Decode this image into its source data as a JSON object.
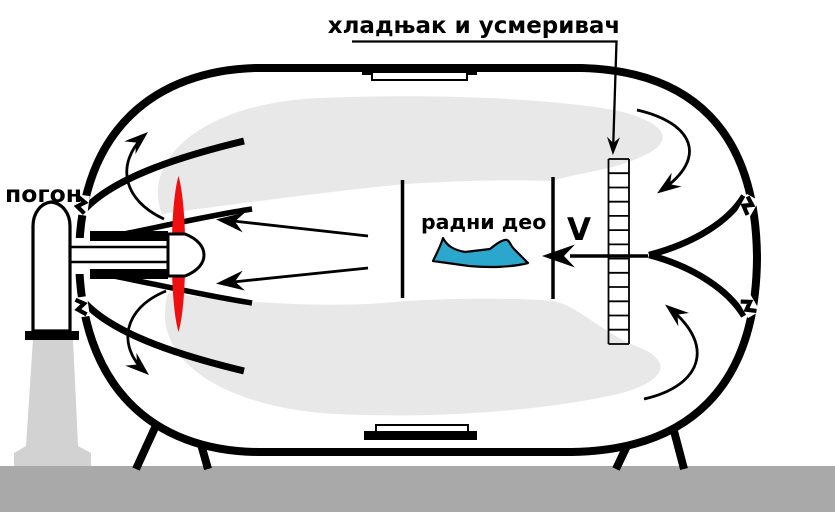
{
  "diagram": {
    "labels": {
      "cooler_straightener": "хладњак и усмеривач",
      "drive": "погон",
      "working_section": "радни део",
      "velocity_symbol": "V"
    },
    "colors": {
      "propeller_red": "#ee1010",
      "aircraft_blue": "#2ba6cd",
      "island_gray": "#e8e8e8",
      "island_edge": "#dddddd",
      "ground_gray": "#a9a9a9",
      "pedestal_gray": "#d2d2d2",
      "outline_black": "#000000",
      "background_white": "#ffffff"
    }
  }
}
